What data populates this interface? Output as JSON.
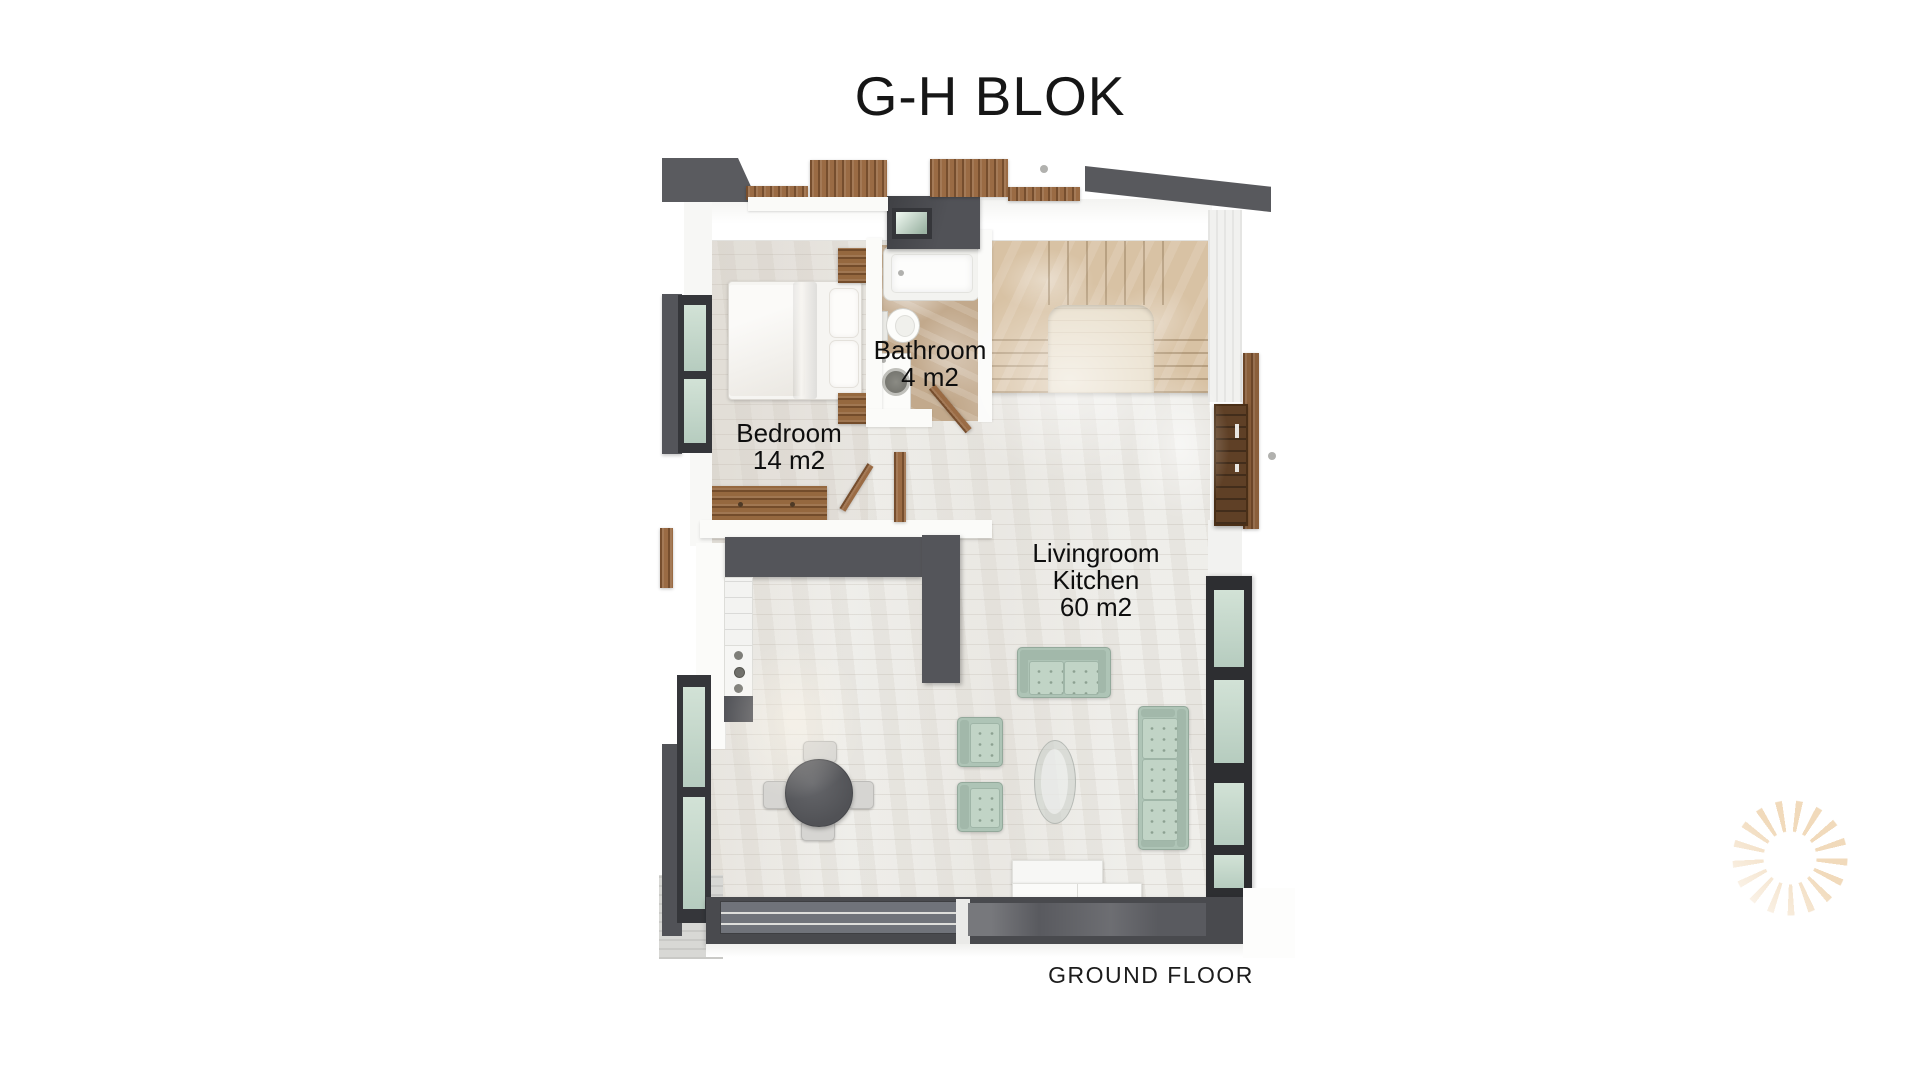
{
  "title": "G-H BLOK",
  "caption": "GROUND FLOOR",
  "rooms": [
    {
      "name": "bedroom",
      "lines": [
        "Bedroom",
        "14 m2"
      ]
    },
    {
      "name": "bathroom",
      "lines": [
        "Bathroom",
        "4 m2"
      ]
    },
    {
      "name": "livingroom-kitchen",
      "lines": [
        "Livingroom",
        "Kitchen",
        "60 m2"
      ]
    }
  ],
  "colors": {
    "wall_dark": "#54555a",
    "window_frame": "#35363a",
    "glass_green": "#c2d8cb",
    "wood": "#9a6b44",
    "walnut_door": "#5f4026",
    "floor_light": "#ecebe7",
    "bathroom_marble": "#c2a98c",
    "stairs_beige": "#d8c2a4",
    "sofa_mint": "#b7cdbf",
    "logo_peach": "#f1dabb",
    "text": "#0e0e0e"
  },
  "logo": {
    "icon": "sun-rays-icon",
    "color": "#f1dabb"
  }
}
